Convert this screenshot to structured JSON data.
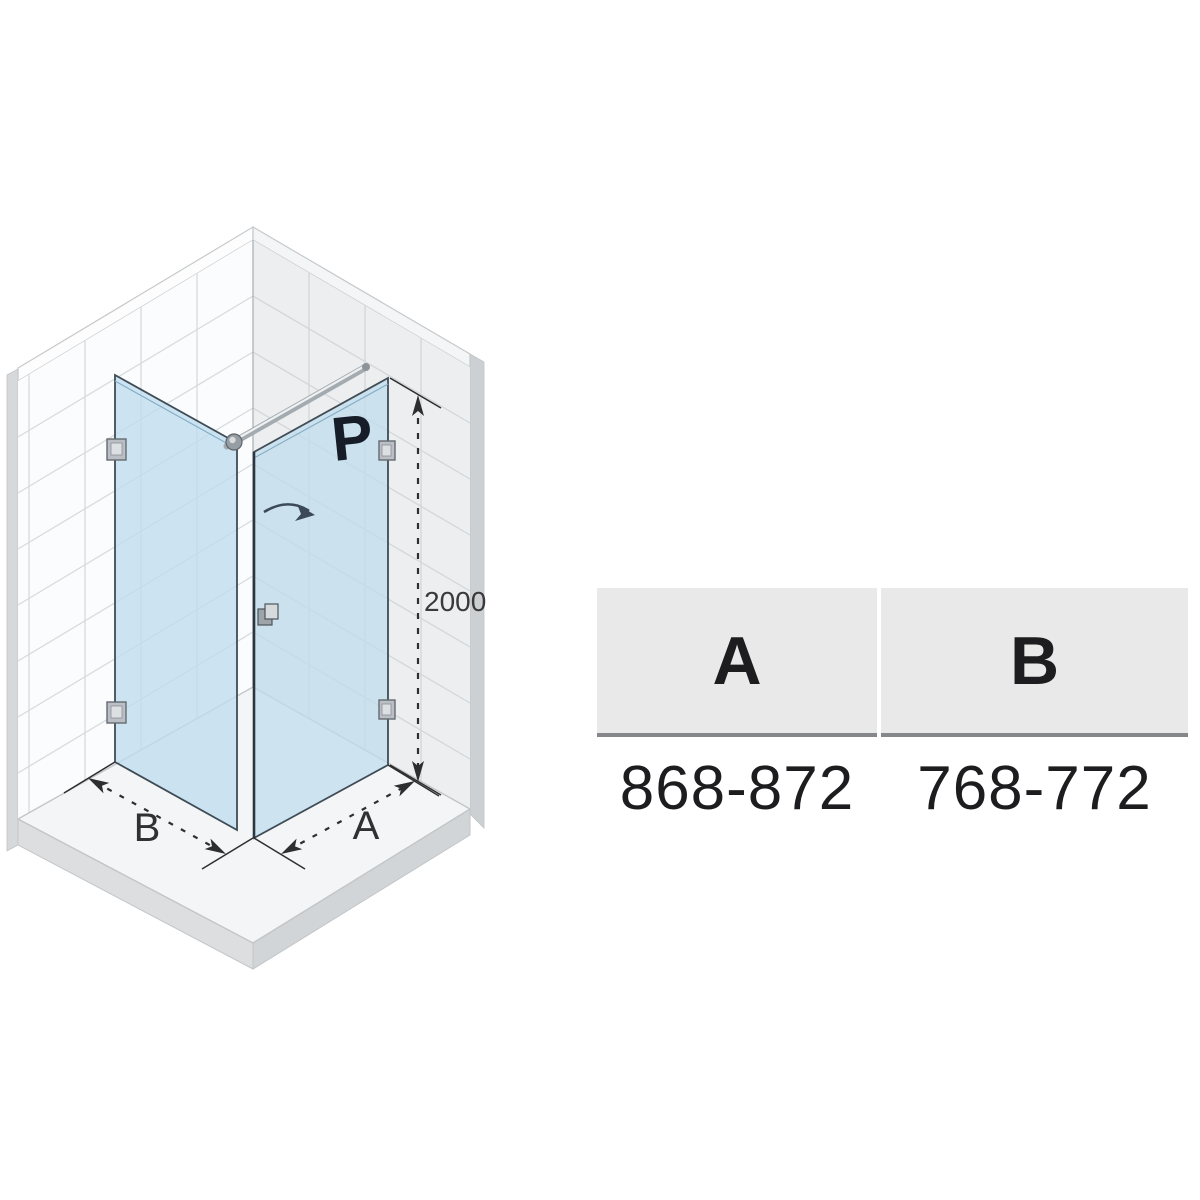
{
  "figure": {
    "type": "corner-shower-enclosure-isometric-drawing",
    "door_label": "P",
    "dimensions": {
      "height": "2000",
      "side_a": "A",
      "side_b": "B"
    }
  },
  "table": {
    "columns": [
      {
        "header": "A",
        "value": "868-872"
      },
      {
        "header": "B",
        "value": "768-772"
      }
    ]
  },
  "colors": {
    "glass": "#bfdcee",
    "glass_edge": "#3f4c56",
    "wall_left": "#fbfcfd",
    "wall_right": "#eceeef",
    "tile_line": "#d7dbdd",
    "floor": "#f4f5f6",
    "slab_edge": "#dcdee0",
    "chrome": "#a4abb0",
    "ink": "#2e2e30",
    "header_bg": "#e9e9ea",
    "header_rule": "#85878a",
    "text": "#1d1d1f"
  }
}
